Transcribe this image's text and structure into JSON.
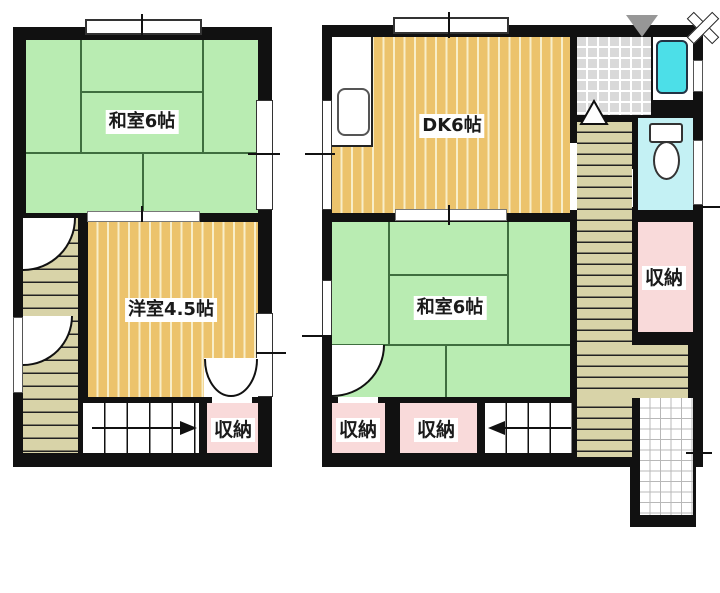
{
  "title": "2-story house floor plan",
  "second_floor": {
    "washitsu_label": "和室6帖",
    "youshitsu_label": "洋室4.5帖",
    "storage_label": "収納"
  },
  "first_floor": {
    "dk_label": "DK6帖",
    "washitsu_label": "和室6帖",
    "storage_right_label": "収納",
    "storage_bottom_left_label": "収納",
    "storage_bottom_mid_label": "収納"
  },
  "colors": {
    "wall": "#111111",
    "tatami_green": "#b9ecb2",
    "seam": "#3f6e3f",
    "wood": "#ecc36c",
    "wood_stripe": "#f8eec9",
    "storage_pink": "#f9dada",
    "stair_beige": "#d8d3a8",
    "tile_grey": "#d9d9d9",
    "bath_cyan": "#4cdfe8",
    "toilet_floor": "#c4f1f4"
  }
}
